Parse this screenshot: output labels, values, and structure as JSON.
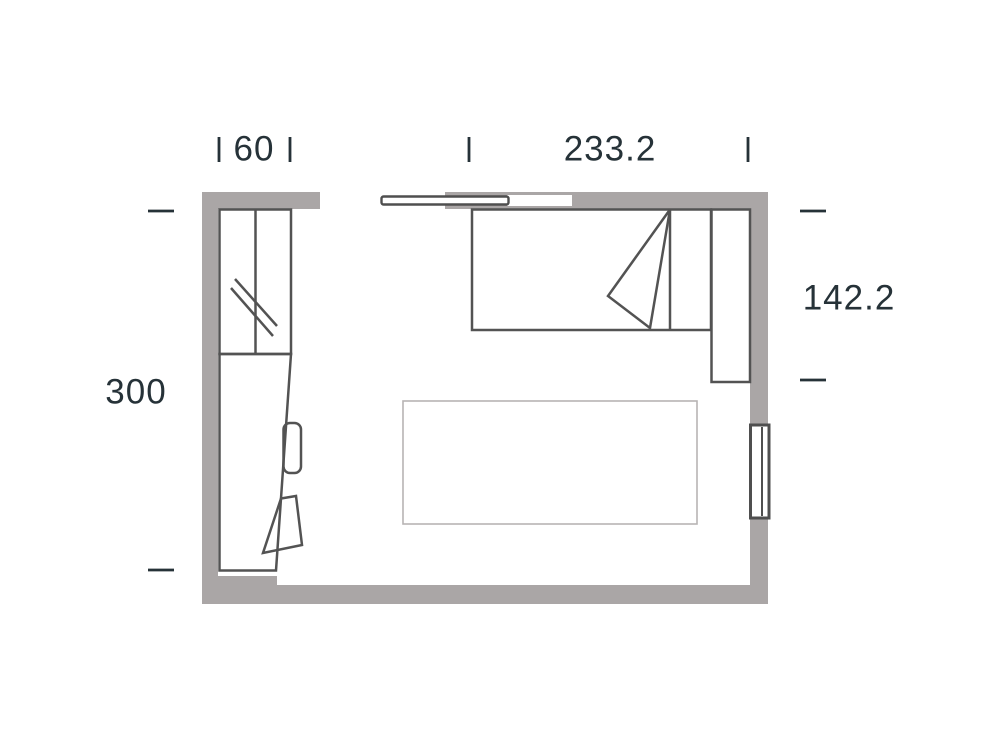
{
  "diagram": {
    "type": "floor-plan",
    "dimensions": {
      "wardrobe_width": "60",
      "bed_wall_width": "233.2",
      "right_height": "142.2",
      "left_height": "300"
    },
    "colors": {
      "wall": "#aaa6a6",
      "furniture_line": "#535353",
      "rug_line": "#b7b4b4",
      "dimension_text": "#263238",
      "background": "#ffffff"
    },
    "elements": [
      "wardrobe-with-mirror",
      "desk",
      "chair",
      "bed",
      "bedside-cabinet",
      "sliding-door",
      "window",
      "rug"
    ]
  }
}
